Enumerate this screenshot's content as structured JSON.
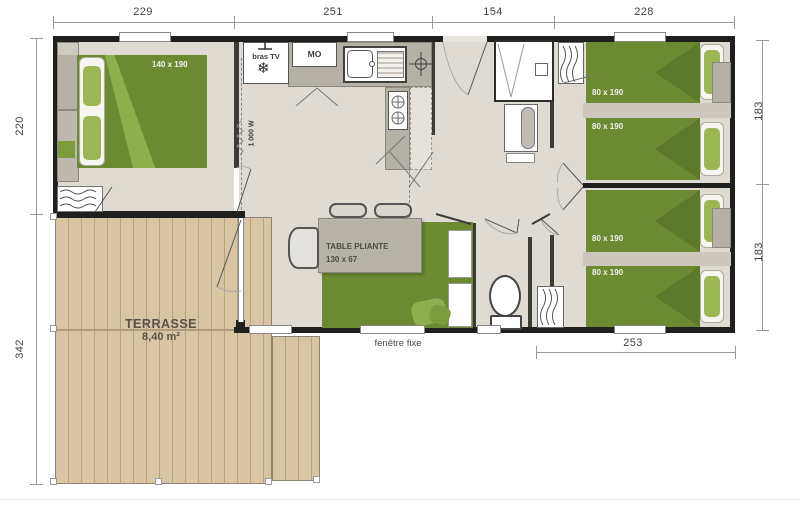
{
  "dims": {
    "top": [
      "229",
      "251",
      "154",
      "228"
    ],
    "left": [
      "220",
      "342"
    ],
    "right": [
      "183",
      "183"
    ],
    "bottom": "253"
  },
  "labels": {
    "master_bed": "140 x 190",
    "bras_tv": "bras TV",
    "micro": "MO",
    "heater": "1 000 W",
    "table_line1": "TABLE PLIANTE",
    "table_line2": "130 x 67",
    "terrace_line1": "TERRASSE",
    "terrace_line2": "8,40 m²",
    "fixed_window": "fenêtre fixe",
    "bed_a1": "80 x 190",
    "bed_a2": "80 x 190",
    "bed_b1": "80 x 190",
    "bed_b2": "80 x 190"
  },
  "icons": {
    "snowflake": "❄"
  },
  "colors": {
    "bed_green": "#6d8a33",
    "deck_wood": "#d9c4a3",
    "wall": "#1f1f1d",
    "counter_gray": "#b6b1a6"
  }
}
